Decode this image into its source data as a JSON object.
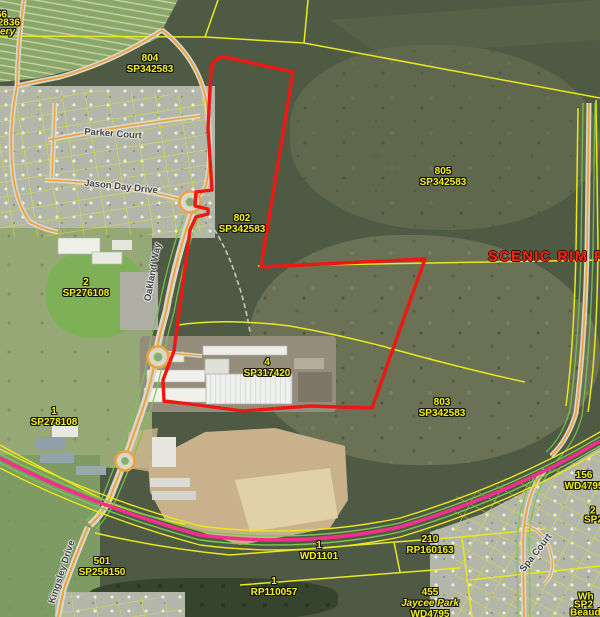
{
  "map": {
    "region_label": "SCENIC RIM R",
    "colors": {
      "parcel_line": "#e9e71d",
      "selection": "#ee1713",
      "highway": "#f0308c",
      "road_centerline": "#eda23d",
      "road_edge": "#7cc64f",
      "label_yellow": "#f2ee1e",
      "region_red": "#ff2513"
    }
  },
  "parcels": [
    {
      "lot": "804",
      "plan": "SP342583"
    },
    {
      "lot": "805",
      "plan": "SP342583"
    },
    {
      "lot": "802",
      "plan": "SP342583"
    },
    {
      "lot": "4",
      "plan": "SP317420"
    },
    {
      "lot": "803",
      "plan": "SP342583"
    },
    {
      "lot": "2",
      "plan": "SP276108"
    },
    {
      "lot": "1",
      "plan": "SP278108"
    },
    {
      "lot": "1",
      "plan": "WD1101"
    },
    {
      "lot": "210",
      "plan": "RP160163"
    },
    {
      "lot": "1",
      "plan": "RP110057"
    },
    {
      "lot": "501",
      "plan": "SP258150"
    },
    {
      "lot": "156",
      "plan": "WD4795"
    },
    {
      "lot": "455",
      "name": "Jaycee Park",
      "plan": "WD4795"
    }
  ],
  "partial_labels": {
    "top_left_1": "66",
    "top_left_2": "2836",
    "top_left_3": "ery",
    "right_1": "2",
    "right_2": "SP2",
    "bottom_right_1": "Wh",
    "bottom_right_2": "SP2",
    "bottom_right_3": "Beaud"
  },
  "streets": {
    "parker": "Parker Court",
    "jason": "Jason Day Drive",
    "oakland": "Oakland Way",
    "kingsley": "Kingsley Drive",
    "spa": "Spa Court"
  }
}
